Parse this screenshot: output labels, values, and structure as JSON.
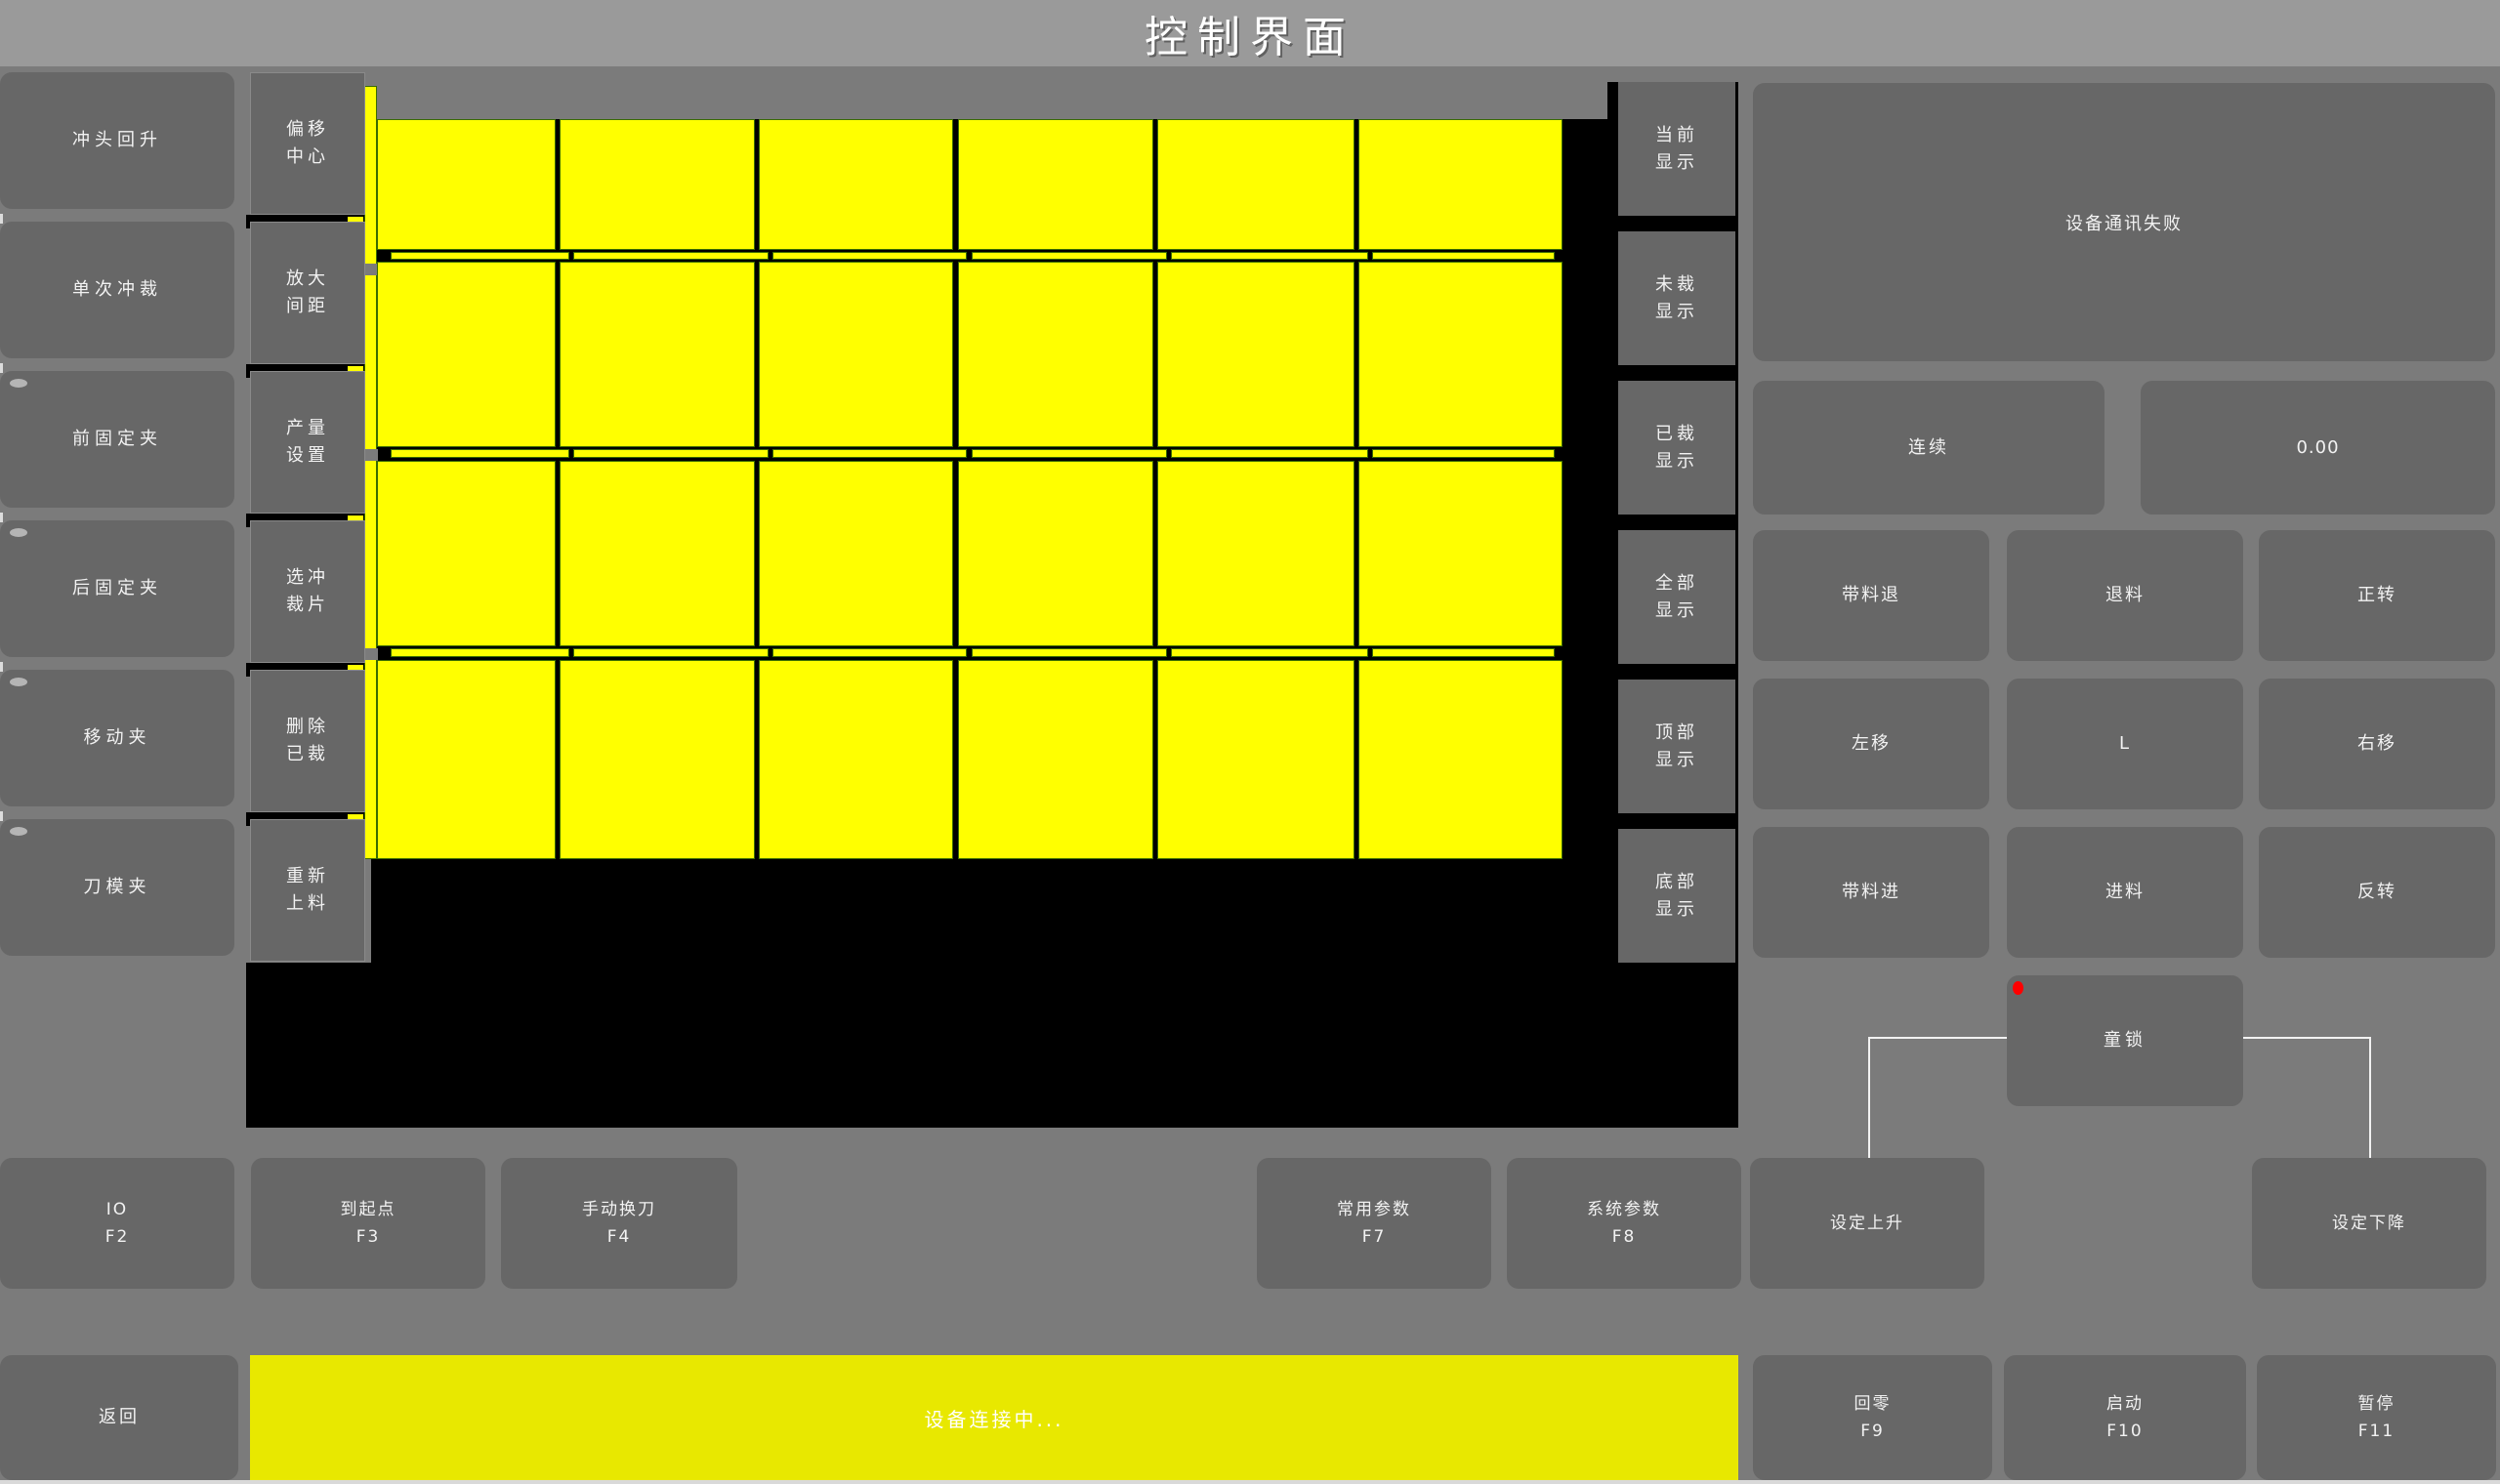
{
  "title": "控制界面",
  "left_buttons": [
    {
      "label": "冲头回升",
      "indicator": false
    },
    {
      "label": "单次冲裁",
      "indicator": false
    },
    {
      "label": "前固定夹",
      "indicator": true
    },
    {
      "label": "后固定夹",
      "indicator": true
    },
    {
      "label": "移动夹",
      "indicator": true
    },
    {
      "label": "刀模夹",
      "indicator": true
    }
  ],
  "tool_buttons": [
    {
      "line1": "偏移",
      "line2": "中心"
    },
    {
      "line1": "放大",
      "line2": "间距"
    },
    {
      "line1": "产量",
      "line2": "设置"
    },
    {
      "line1": "选冲",
      "line2": "裁片"
    },
    {
      "line1": "删除",
      "line2": "已裁"
    },
    {
      "line1": "重新",
      "line2": "上料"
    }
  ],
  "display_buttons": [
    {
      "line1": "当前",
      "line2": "显示"
    },
    {
      "line1": "未裁",
      "line2": "显示"
    },
    {
      "line1": "已裁",
      "line2": "显示"
    },
    {
      "line1": "全部",
      "line2": "显示"
    },
    {
      "line1": "顶部",
      "line2": "显示"
    },
    {
      "line1": "底部",
      "line2": "显示"
    }
  ],
  "workpiece_preview": {
    "columns": 6,
    "rows": 4,
    "piece_fill": "#ffff00",
    "piece_border": "#3a6b00",
    "canvas_background": "#000000"
  },
  "right_panel": {
    "message": "设备通讯失败",
    "mode_button": "连续",
    "value_display": "0.00",
    "jog_buttons": [
      [
        "带料退",
        "退料",
        "正转"
      ],
      [
        "左移",
        "L",
        "右移"
      ],
      [
        "带料进",
        "进料",
        "反转"
      ]
    ],
    "lock_button": "童锁",
    "lock_indicator_color": "#ff0000"
  },
  "function_row": [
    {
      "label": "IO",
      "fkey": "F2"
    },
    {
      "label": "到起点",
      "fkey": "F3"
    },
    {
      "label": "手动换刀",
      "fkey": "F4"
    },
    {
      "label": "常用参数",
      "fkey": "F7"
    },
    {
      "label": "系统参数",
      "fkey": "F8"
    },
    {
      "label": "设定上升",
      "fkey": ""
    },
    {
      "label": "设定下降",
      "fkey": ""
    }
  ],
  "bottom_bar": {
    "back_button": "返回",
    "status_message": "设备连接中...",
    "status_bg": "#e8e800",
    "control_buttons": [
      {
        "label": "回零",
        "fkey": "F9"
      },
      {
        "label": "启动",
        "fkey": "F10"
      },
      {
        "label": "暂停",
        "fkey": "F11"
      }
    ]
  },
  "colors": {
    "background": "#7b7b7b",
    "titlebar": "#9a9a9a",
    "button": "#676767",
    "canvas": "#000000",
    "piece_yellow": "#ffff00",
    "status_yellow": "#e8e800",
    "text": "#f2f2f2"
  }
}
